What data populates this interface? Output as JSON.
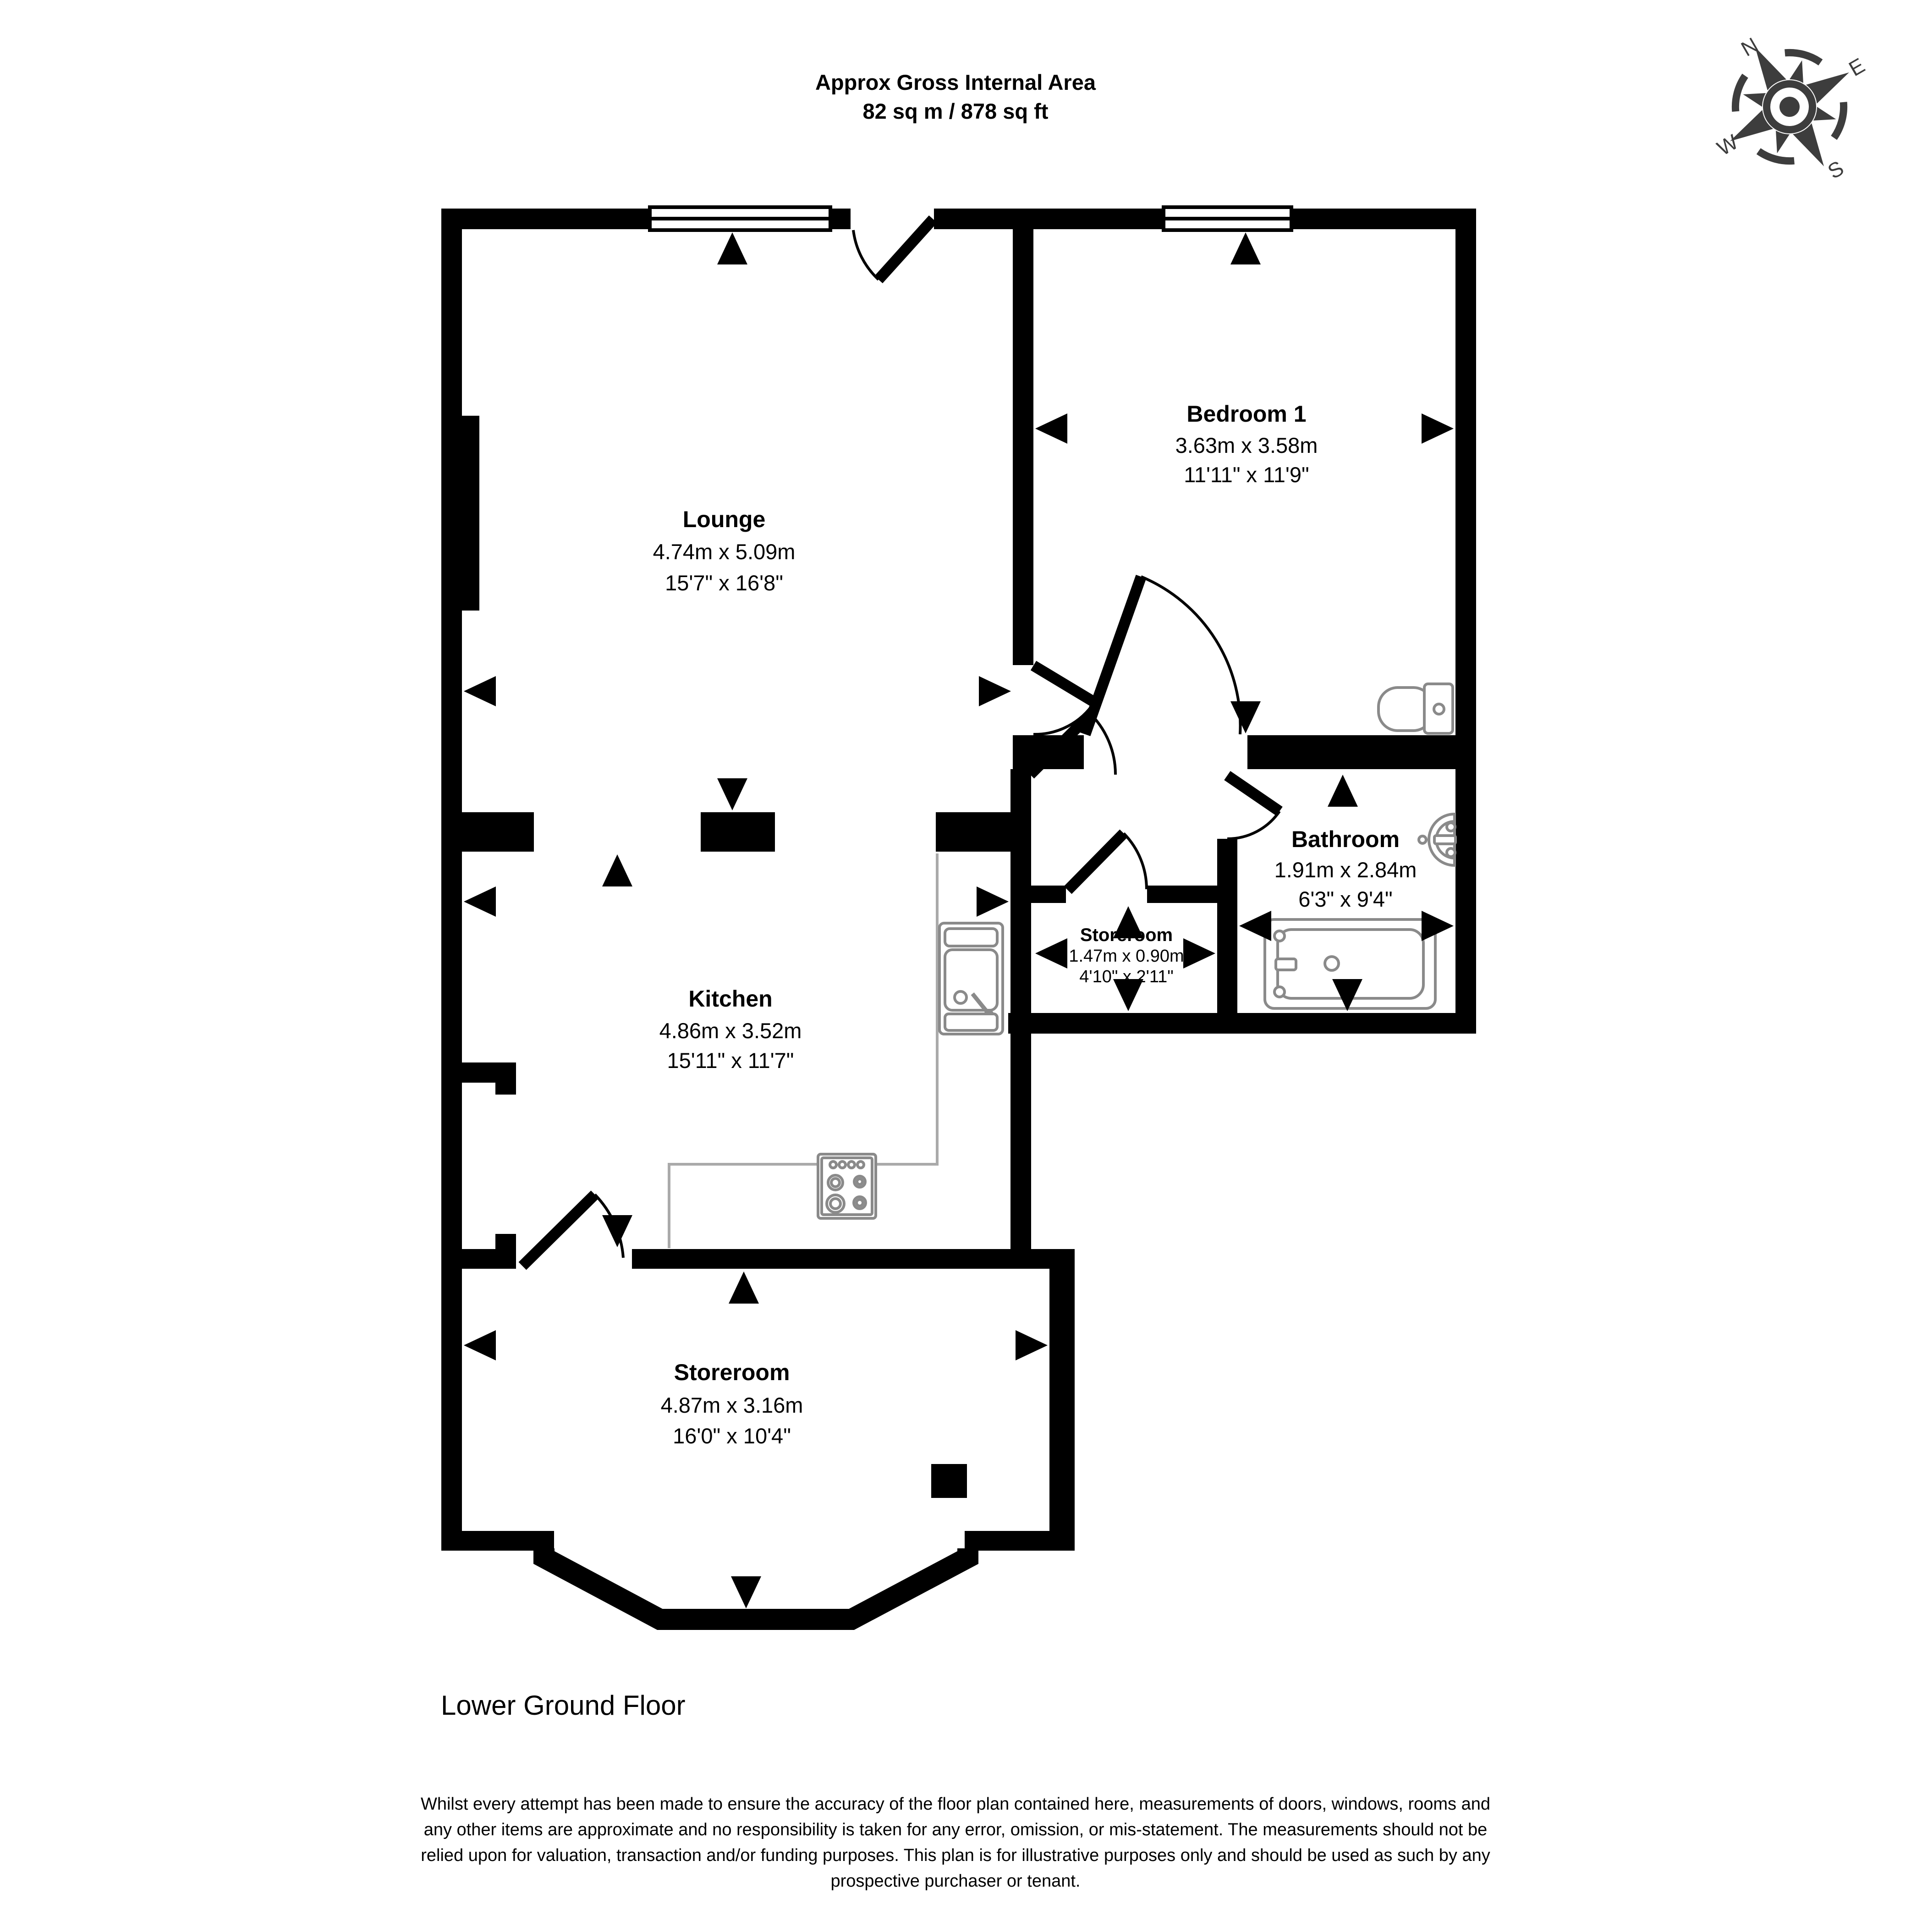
{
  "header": {
    "line1": "Approx Gross Internal Area",
    "line2": "82 sq m / 878 sq ft"
  },
  "compass": {
    "north": "N",
    "east": "E",
    "south": "S",
    "west": "W"
  },
  "rooms": {
    "lounge": {
      "name": "Lounge",
      "metric": "4.74m x 5.09m",
      "imperial": "15'7\" x 16'8\""
    },
    "bedroom1": {
      "name": "Bedroom 1",
      "metric": "3.63m x 3.58m",
      "imperial": "11'11\" x 11'9\""
    },
    "bathroom": {
      "name": "Bathroom",
      "metric": "1.91m x 2.84m",
      "imperial": "6'3\" x 9'4\""
    },
    "storeroom_small": {
      "name": "Storeroom",
      "metric": "1.47m x 0.90m",
      "imperial": "4'10\" x 2'11\""
    },
    "kitchen": {
      "name": "Kitchen",
      "metric": "4.86m x 3.52m",
      "imperial": "15'11\" x 11'7\""
    },
    "storeroom": {
      "name": "Storeroom",
      "metric": "4.87m x 3.16m",
      "imperial": "16'0\" x 10'4\""
    }
  },
  "floor_label": "Lower Ground Floor",
  "disclaimer": {
    "line1": "Whilst every attempt has been made to ensure the accuracy of the floor plan contained here, measurements of doors, windows, rooms and",
    "line2": "any other items are approximate and no responsibility is taken for any error, omission, or mis-statement. The measurements should not be",
    "line3": "relied upon for valuation, transaction and/or funding purposes. This plan is for illustrative purposes only and should be used as such by any",
    "line4": "prospective purchaser or tenant."
  },
  "colors": {
    "walls": "#000000",
    "fixtures": "#8a8a8a",
    "compass": "#3d3d3d",
    "background": "#ffffff"
  }
}
